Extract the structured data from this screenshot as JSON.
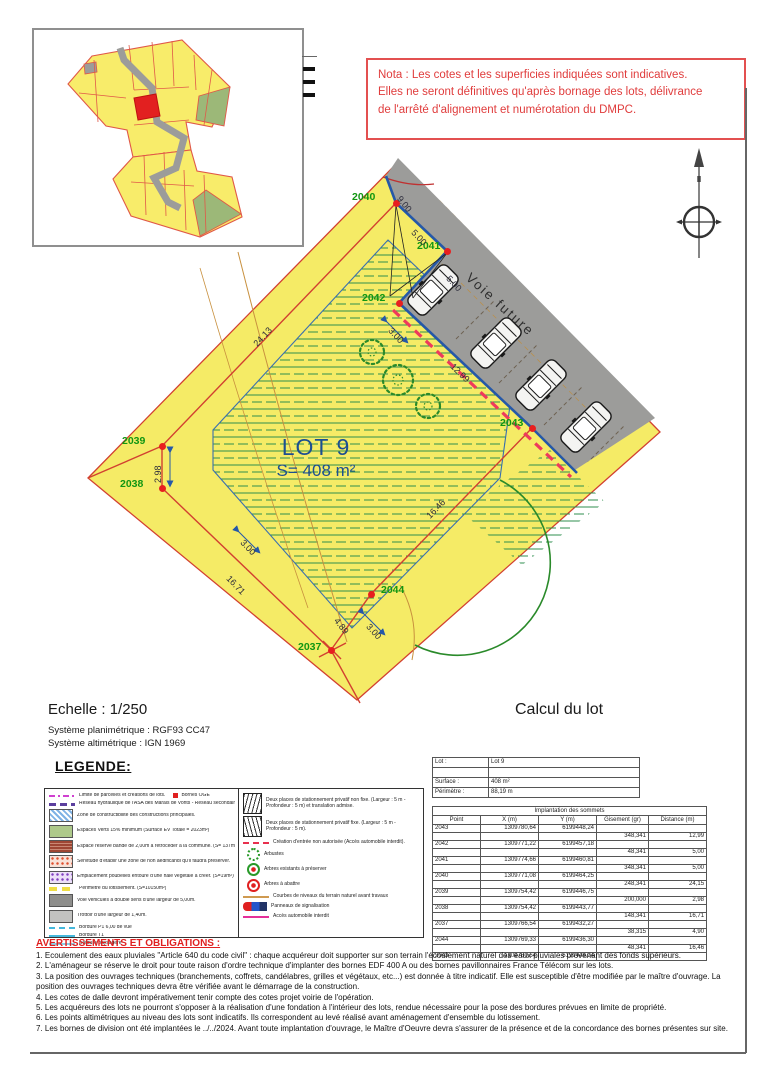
{
  "nota": {
    "text": "Nota : Les cotes et les superficies indiquées sont indicatives.\nElles ne seront définitives qu'après bornage des lots, délivrance\nde l'arrêté d'alignement et numérotation du DMPC."
  },
  "plan": {
    "lot_label": "LOT 9",
    "lot_area": "S= 408 m²",
    "road_label": "Voie future",
    "points": [
      {
        "id": "2040",
        "x": 396,
        "y": 203,
        "lx": 352,
        "ly": 191
      },
      {
        "id": "2041",
        "x": 447,
        "y": 251,
        "lx": 417,
        "ly": 240
      },
      {
        "id": "2042",
        "x": 399,
        "y": 303,
        "lx": 362,
        "ly": 292
      },
      {
        "id": "2043",
        "x": 532,
        "y": 428,
        "lx": 500,
        "ly": 417
      },
      {
        "id": "2039",
        "x": 162,
        "y": 446,
        "lx": 122,
        "ly": 435
      },
      {
        "id": "2038",
        "x": 162,
        "y": 488,
        "lx": 120,
        "ly": 478
      },
      {
        "id": "2037",
        "x": 331,
        "y": 650,
        "lx": 298,
        "ly": 641
      },
      {
        "id": "2044",
        "x": 371,
        "y": 594,
        "lx": 381,
        "ly": 584
      }
    ],
    "dimensions": [
      {
        "t": "9.00",
        "x": 399,
        "y": 192,
        "r": 52
      },
      {
        "t": "5.00",
        "x": 413,
        "y": 226,
        "r": 47
      },
      {
        "t": "5.00",
        "x": 448,
        "y": 272,
        "r": 47
      },
      {
        "t": "3.00",
        "x": 390,
        "y": 324,
        "r": 47
      },
      {
        "t": "12.99",
        "x": 452,
        "y": 360,
        "r": 44
      },
      {
        "t": "24.13",
        "x": 255,
        "y": 340,
        "r": -47
      },
      {
        "t": "2.98",
        "x": 158,
        "y": 478,
        "r": -90
      },
      {
        "t": "3.00",
        "x": 242,
        "y": 536,
        "r": 46
      },
      {
        "t": "16.71",
        "x": 228,
        "y": 572,
        "r": 46
      },
      {
        "t": "4.89",
        "x": 336,
        "y": 614,
        "r": 52
      },
      {
        "t": "3.00",
        "x": 368,
        "y": 620,
        "r": 48
      },
      {
        "t": "16.46",
        "x": 428,
        "y": 512,
        "r": -46
      }
    ]
  },
  "scale_block": {
    "echelle": "Echelle : 1/250",
    "planimetrique": "Système planimétrique : RGF93 CC47",
    "altimetrique": "Système altimétrique : IGN 1969"
  },
  "calcul": {
    "title": "Calcul du lot",
    "lot_info": {
      "rows": [
        [
          "Lot :",
          "Lot 9"
        ],
        [
          "",
          ""
        ],
        [
          "Surface :",
          "408 m²"
        ],
        [
          "Périmètre :",
          "88,19 m"
        ]
      ]
    },
    "sommets": {
      "title": "Implantation des sommets",
      "headers": [
        "Point",
        "X (m)",
        "Y (m)",
        "Gisement (gr)",
        "Distance (m)"
      ],
      "rows": [
        [
          "2043",
          "1309780,64",
          "6199448,24",
          "",
          ""
        ],
        [
          "",
          "",
          "",
          "348,341",
          "12,99"
        ],
        [
          "2042",
          "1309771,22",
          "6199457,18",
          "",
          ""
        ],
        [
          "",
          "",
          "",
          "48,341",
          "5,00"
        ],
        [
          "2041",
          "1309774,66",
          "6199460,81",
          "",
          ""
        ],
        [
          "",
          "",
          "",
          "348,341",
          "5,00"
        ],
        [
          "2040",
          "1309771,08",
          "6199464,25",
          "",
          ""
        ],
        [
          "",
          "",
          "",
          "248,341",
          "24,15"
        ],
        [
          "2039",
          "1309754,42",
          "6199446,75",
          "",
          ""
        ],
        [
          "",
          "",
          "",
          "200,000",
          "2,98"
        ],
        [
          "2038",
          "1309754,42",
          "6199443,77",
          "",
          ""
        ],
        [
          "",
          "",
          "",
          "148,341",
          "16,71"
        ],
        [
          "2037",
          "1309766,54",
          "6199432,27",
          "",
          ""
        ],
        [
          "",
          "",
          "",
          "38,315",
          "4,90"
        ],
        [
          "2044",
          "1309769,33",
          "6199436,30",
          "",
          ""
        ],
        [
          "",
          "",
          "",
          "48,341",
          "16,46"
        ],
        [
          "2043",
          "1309780,64",
          "6199448,24",
          "",
          ""
        ]
      ]
    }
  },
  "legende": {
    "title": "LEGENDE:",
    "left": [
      {
        "sym": "limite",
        "text": "Limite de parcelles et créations de lots.",
        "sym2": "borne",
        "text2": "Bornes OGE"
      },
      {
        "sym": "reseau-hydro",
        "text": "Réseau hydraulique de l'ASA des Marais de Vonts - Réseau secondaire"
      },
      {
        "sym": "zone-constructibilite",
        "text": "Zone de constructibilité des constructions principales."
      },
      {
        "sym": "espaces-verts",
        "text": "Espaces Verts 15% minimum (Surface EV Totale = 2023m²)"
      },
      {
        "sym": "bande-retroceder",
        "text": "Espace réservé bande de 2,00m à rétrocéder à la commune. (S= 137m²)"
      },
      {
        "sym": "zone-non-aedificandi",
        "text": "Servitude d'établir une zone de non aedificandi qu'il faudra préserver."
      },
      {
        "sym": "emplacement-poubelles",
        "text": "Emplacement poubelles entouré d'une haie végétale à créer. (S=19m²)"
      },
      {
        "sym": "perimetre",
        "text": "Périmètre du lotissement. (S=10150m²)"
      },
      {
        "sym": "voie-vehicules",
        "text": "Voie véhicules à double sens d'une largeur de 5,00m."
      },
      {
        "sym": "trottoir",
        "text": "Trottoir d'une largeur de 1,40m."
      },
      {
        "sym": "bordure-p1",
        "text": "Bordure P1 6,00 de vue"
      },
      {
        "sym": "bordure-t1",
        "text": "Bordure T1"
      },
      {
        "sym": "bordure-paysagere",
        "text": "Bordure paysagère"
      }
    ],
    "right": [
      {
        "sym": "stationnement-non-fixe",
        "text": "Deux places de stationnement privatif non fixe. (Largeur : 5 m - Profondeur : 5 m) et translation admise."
      },
      {
        "sym": "stationnement-fixe",
        "text": "Deux places de stationnement privatif fixe. (Largeur : 5 m - Profondeur : 5 m)."
      },
      {
        "sym": "creation-entree",
        "text": "Création d'entrée non autorisée (Accès automobile interdit)."
      },
      {
        "sym": "arbustes",
        "text": "Arbustes"
      },
      {
        "sym": "arbres-preserver",
        "text": "Arbres existants à préserver"
      },
      {
        "sym": "arbres-abattre",
        "text": "Arbres à abattre"
      },
      {
        "sym": "courbes-niveaux",
        "text": "Courbes de niveaux du terrain naturel avant travaux"
      },
      {
        "sym": "panneaux",
        "text": "Panneaux de signalisation"
      },
      {
        "sym": "acces-interdit",
        "text": "Accès automobile interdit"
      }
    ]
  },
  "avertissements": {
    "title": "AVERTISSEMENTS ET OBLIGATIONS :",
    "items": [
      "1. Ecoulement des eaux pluviales \"Article 640 du code civil\" : chaque acquéreur doit supporter sur son terrain l'écoulement naturel des  eaux pluviales provenant des fonds supérieurs.",
      "2. L'aménageur se réserve le droit pour toute raison d'ordre technique d'implanter des bornes EDF 400 A ou des bornes pavillonnaires France Télécom sur les lots.",
      "3. La position des ouvrages techniques (branchements, coffrets, candélabres, grilles et végétaux, etc...) est donnée à titre indicatif. Elle est susceptible d'être modifiée par le maître d'ouvrage. La position des ouvrages techniques devra être vérifiée avant le démarrage de la construction.",
      "4. Les cotes de dalle devront impérativement tenir compte des cotes projet voirie de l'opération.",
      "5. Les acquéreurs des lots ne pourront s'opposer à la réalisation d'une fondation à l'intérieur des lots, rendue nécessaire pour la pose des bordures prévues en limite de propriété.",
      "6. Les points altimétriques au niveau des lots sont indicatifs. Ils correspondent au levé réalisé avant aménagement d'ensemble du lotissement.",
      "7. Les bornes de division ont été implantées le ../../2024. Avant toute implantation d'ouvrage, le Maître d'Oeuvre devra s'assurer de la présence et de la concordance des bornes présentes sur site."
    ]
  },
  "colors": {
    "nota_red": "#e03c3c",
    "parcel_yellow": "#f5eb66",
    "road_gray": "#9c9c9a",
    "boundary_blue": "#2558a8",
    "point_green": "#129612",
    "limit_red": "#d24030",
    "no_access_dashed": "#ee3a5c"
  }
}
